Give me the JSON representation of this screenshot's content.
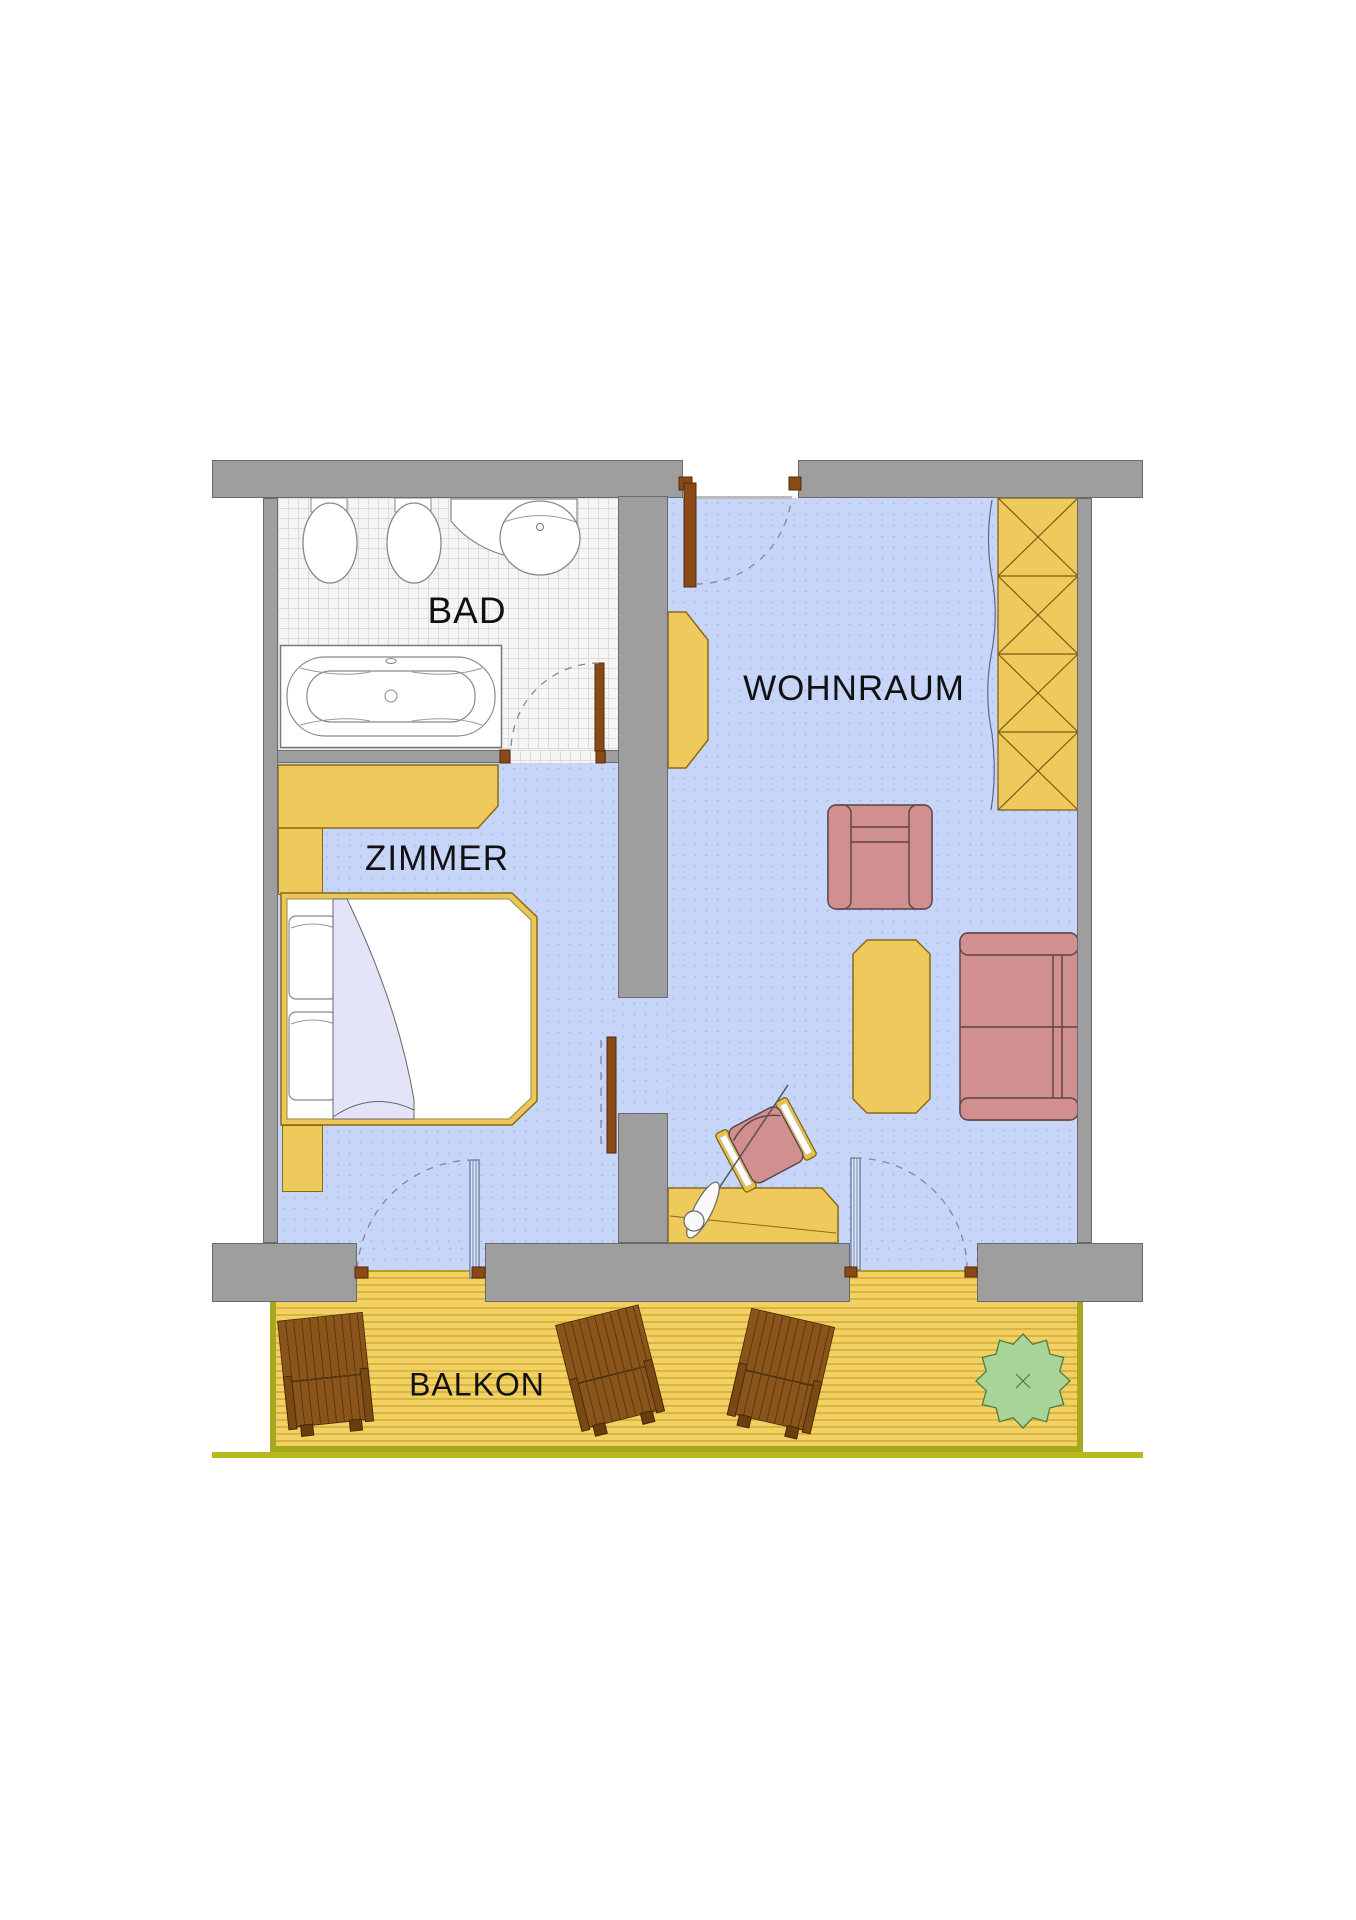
{
  "plan": {
    "type": "apartment-floor-plan",
    "labels": {
      "bad": "BAD",
      "zimmer": "ZIMMER",
      "wohnraum": "WOHNRAUM",
      "balkon": "BALKON"
    }
  },
  "colors": {
    "wall_gray": "#9e9e9e",
    "room_floor_blue": "#c7d5f8",
    "bath_tile_white": "#f5f5f3",
    "furniture_wood_yellow": "#eec95c",
    "upholstery_rose": "#d18f8f",
    "door_wood_brown": "#8a4a15",
    "balcony_deck_yellow": "#f2d063",
    "deck_border_olive": "#a8a81e",
    "deck_chair_brown": "#8a551a",
    "plant_green": "#a8d49a",
    "balcony_door_glass": "#dbe4f8",
    "label_text": "#111111"
  },
  "furniture_icons": [
    "bathtub-icon",
    "washbasin-icon",
    "toilet-icon",
    "bidet-icon",
    "wardrobe-icon",
    "double-bed-icon",
    "nightstand-icon",
    "tall-closet-x-icon",
    "curtain-icon",
    "shelf-icon",
    "armchair-icon",
    "sofa-icon",
    "coffee-table-icon",
    "desk-icon",
    "desk-chair-icon",
    "desk-lamp-icon",
    "entrance-door-icon",
    "bathroom-door-icon",
    "room-door-icon",
    "balcony-door-icon",
    "deck-chair-icon",
    "potted-plant-icon"
  ]
}
